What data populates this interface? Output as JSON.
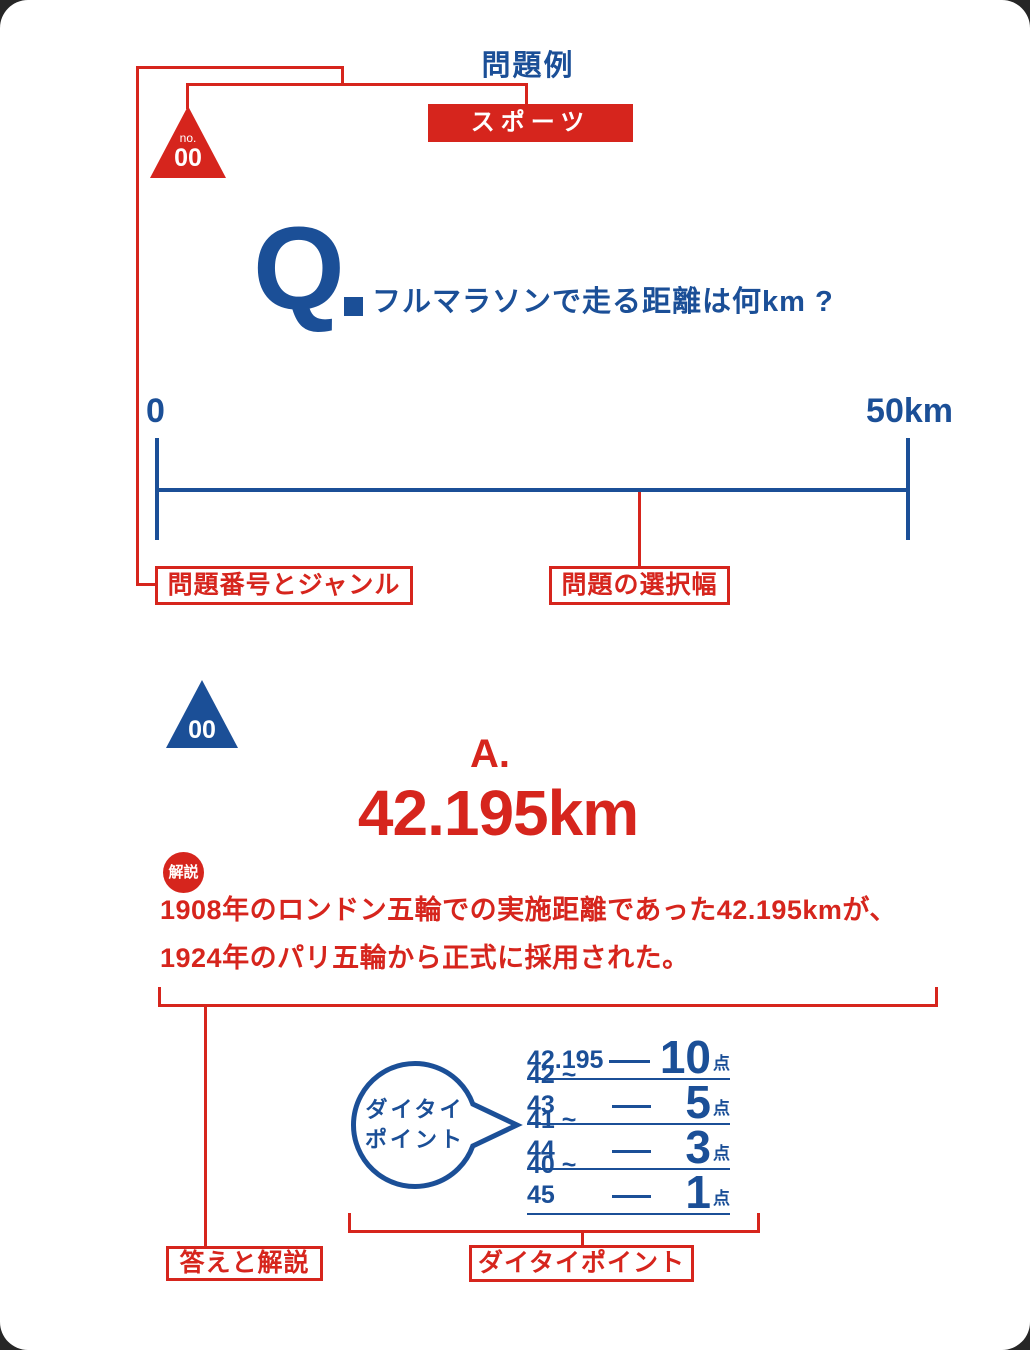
{
  "colors": {
    "red": "#d6251d",
    "blue": "#1b4f97"
  },
  "header": {
    "title": "問題例"
  },
  "sample_question": {
    "no_label": "no.",
    "number": "00",
    "genre": "スポーツ",
    "q_mark": "Q",
    "question": "フルマラソンで走る距離は何km ?",
    "scale": {
      "min": "0",
      "max": "50km"
    }
  },
  "sample_answer": {
    "number": "00",
    "a_mark": "A.",
    "value": "42.195km",
    "badge": "解説",
    "explanation_line1": "1908年のロンドン五輪での実施距離であった42.195kmが、",
    "explanation_line2": "1924年のパリ五輪から正式に採用された。"
  },
  "points": {
    "bubble_line1": "ダイタイ",
    "bubble_line2": "ポイント",
    "rows": [
      {
        "range": "42.195",
        "score": "10",
        "unit": "点"
      },
      {
        "range": "42 ~ 43",
        "score": "5",
        "unit": "点"
      },
      {
        "range": "41 ~ 44",
        "score": "3",
        "unit": "点"
      },
      {
        "range": "40 ~ 45",
        "score": "1",
        "unit": "点"
      }
    ]
  },
  "callouts": {
    "genre": "問題番号とジャンル",
    "range": "問題の選択幅",
    "answer": "答えと解説",
    "points": "ダイタイポイント"
  }
}
